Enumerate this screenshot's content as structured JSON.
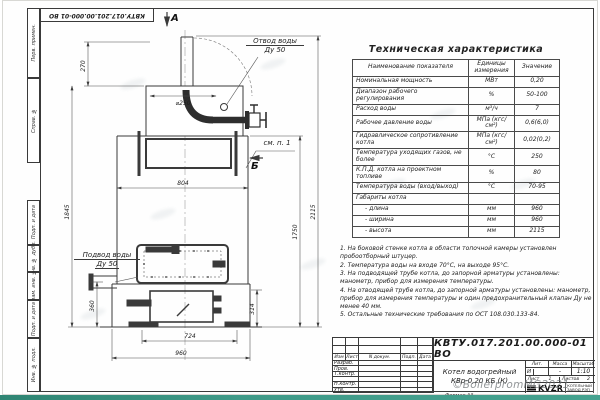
{
  "sheet": {
    "format_label": "Формат А3",
    "watermark": "©BoilerpromMG2021"
  },
  "frame_left": {
    "items": [
      "Перв. примен.",
      "Справ. №",
      "Подп. и дата",
      "Инв. № дубл.",
      "Взам. инв. №",
      "Подп. и дата",
      "Инв. № подл."
    ]
  },
  "drawing": {
    "labels": {
      "view_a": "А",
      "view_b": "Б",
      "see_note": "см. п. 1",
      "outlet_line1": "Отвод воды",
      "outlet_line2": "Ду 50",
      "inlet_line1": "Подвод воды",
      "inlet_line2": "Ду 50",
      "dia": "⌀250"
    },
    "dims": {
      "d270": "270",
      "d1845": "1845",
      "d360": "360",
      "d804": "804",
      "d724": "724",
      "d960": "960",
      "d314": "314",
      "d1750": "1750",
      "d2115": "2115"
    }
  },
  "spec_table": {
    "title": "Техническая характеристика",
    "headers": [
      "Наименование показателя",
      "Единицы измерения",
      "Значение"
    ],
    "rows": [
      [
        "Номинальная мощность",
        "МВт",
        "0,20"
      ],
      [
        "Диапазон рабочего регулирования",
        "%",
        "50-100"
      ],
      [
        "Расход воды",
        "м³/ч",
        "7"
      ],
      [
        "Рабочее давление воды",
        "МПа (кгс/см²)",
        "0,6(6,0)"
      ],
      [
        "Гидравлическое сопротивление котла",
        "МПа (кгс/см²)",
        "0,02(0,2)"
      ],
      [
        "Температура уходящих газов, не более",
        "°С",
        "250"
      ],
      [
        "К.П.Д. котла на проектном топливе",
        "%",
        "80"
      ],
      [
        "Температура воды (вход/выход)",
        "°С",
        "70-95"
      ],
      [
        "Габариты котла",
        "",
        ""
      ],
      [
        "- длина",
        "мм",
        "960"
      ],
      [
        "- ширина",
        "мм",
        "960"
      ],
      [
        "- высота",
        "мм",
        "2115"
      ]
    ]
  },
  "notes": [
    "1. На боковой стенке котла в области топочной камеры установлен пробоотборный штуцер.",
    "2. Температура воды на входе 70°С, на выходе 95°С.",
    "3. На подводящей трубе котла, до запорной арматуры установлены: манометр, прибор для измерения температуры.",
    "4. На отводящей трубе котла, до запорной арматуры установлены: манометр, прибор для измерения температуры и один предохранительный клапан Ду не менее 40 мм.",
    "5. Остальные технические требования по ОСТ 108.030.133-84."
  ],
  "title_block": {
    "doc_number": "КВТУ.017.201.00.000-01 ВО",
    "product_title_line1": "Котел водогрейный",
    "product_title_line2": "КВр-0,20 КБ  (К)",
    "header_cols": [
      "Изм",
      "Лист",
      "N докум.",
      "Подп.",
      "Дата"
    ],
    "sign_rows": [
      "Разраб.",
      "Пров.",
      "Т.контр.",
      "",
      "Н.контр.",
      "Утв."
    ],
    "lit_label": "Лит.",
    "mass_label": "Масса",
    "scale_label": "Масштаб",
    "lit_value": "И",
    "mass_value": "-",
    "scale_value": "1:10",
    "sheet_label": "Лист",
    "sheet_value": "1",
    "sheets_label": "Листов",
    "sheets_value": "2",
    "logo_text": "KVZR",
    "logo_caption_line1": "КОТЕЛЬНЫЙ",
    "logo_caption_line2": "ЗАВОД РЭП"
  }
}
